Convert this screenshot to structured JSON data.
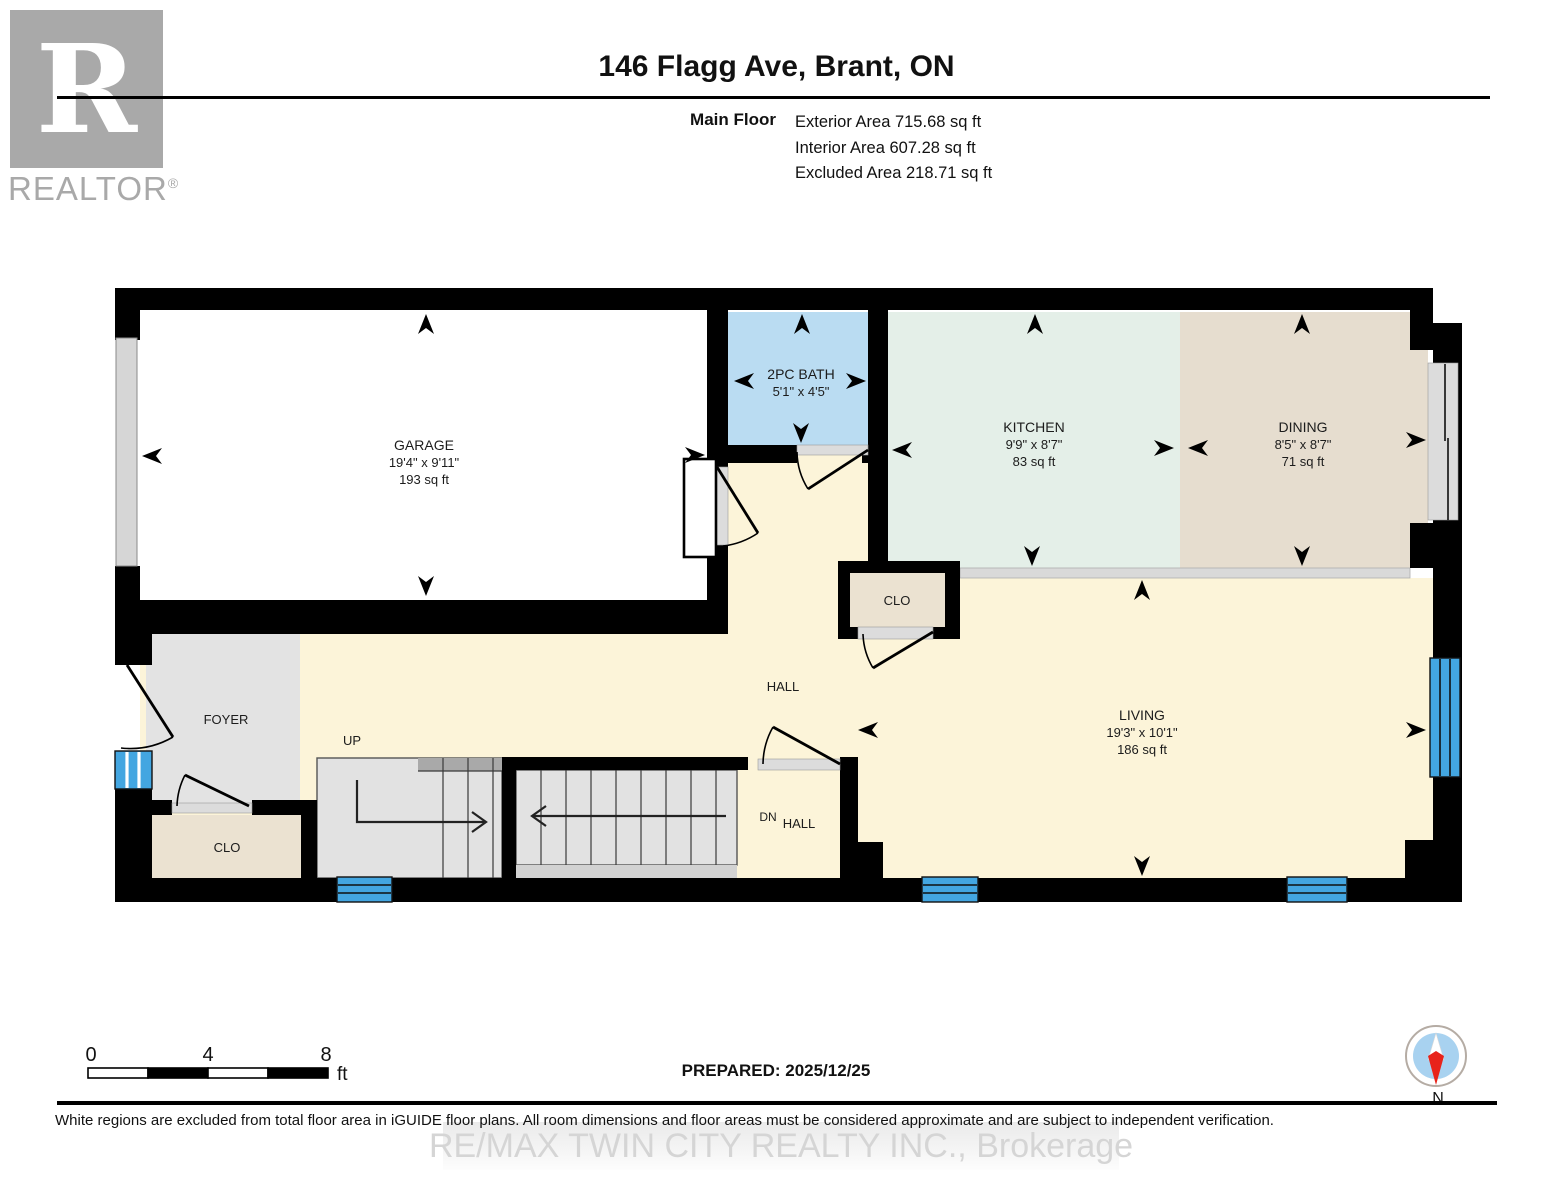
{
  "header": {
    "logo_letter": "R",
    "logo_text": "REALTOR",
    "logo_reg": "®",
    "title": "146 Flagg Ave, Brant, ON",
    "floor_label": "Main Floor",
    "areas": [
      "Exterior Area 715.68 sq ft",
      "Interior Area 607.28 sq ft",
      "Excluded Area 218.71 sq ft"
    ]
  },
  "rooms": {
    "garage": {
      "name": "GARAGE",
      "dims": "19'4\" x 9'11\"",
      "area": "193 sq ft"
    },
    "bath": {
      "name": "2PC BATH",
      "dims": "5'1\" x 4'5\""
    },
    "kitchen": {
      "name": "KITCHEN",
      "dims": "9'9\" x 8'7\"",
      "area": "83 sq ft"
    },
    "dining": {
      "name": "DINING",
      "dims": "8'5\" x 8'7\"",
      "area": "71 sq ft"
    },
    "living": {
      "name": "LIVING",
      "dims": "19'3\" x 10'1\"",
      "area": "186 sq ft"
    },
    "hall": {
      "name": "HALL"
    },
    "foyer": {
      "name": "FOYER"
    },
    "closet_kitchen": {
      "name": "CLO"
    },
    "closet_foyer": {
      "name": "CLO"
    },
    "stairs_up": {
      "name": "UP"
    },
    "stairs_dn": {
      "name": "DN"
    },
    "lower_hall": {
      "name": "HALL"
    }
  },
  "scale_bar": {
    "start": "0",
    "mid": "4",
    "end": "8",
    "unit": "ft"
  },
  "prepared": "PREPARED: 2025/12/25",
  "compass": {
    "label": "N"
  },
  "footer": {
    "disclaimer": "White regions are excluded from total floor area in iGUIDE floor plans. All room dimensions and floor areas must be considered approximate and are subject to independent verification.",
    "watermark": "RE/MAX TWIN CITY REALTY INC., Brokerage"
  },
  "colors": {
    "garage": "#ffffff",
    "bath": "#badcf2",
    "kitchen": "#e4efe8",
    "dining": "#e6ddcf",
    "hall": "#fcf4d9",
    "closet": "#ebe2d1",
    "foyer": "#e3e3e3",
    "stairs": "#e2e2e2",
    "landing": "#a9a9a9",
    "sill": "#dcdcdc",
    "window": "#43a6e1",
    "wall": "#000000",
    "compass_red": "#e8231a",
    "compass_blue": "#a8d2f0",
    "watermark_gray": "#d5d5d5"
  }
}
